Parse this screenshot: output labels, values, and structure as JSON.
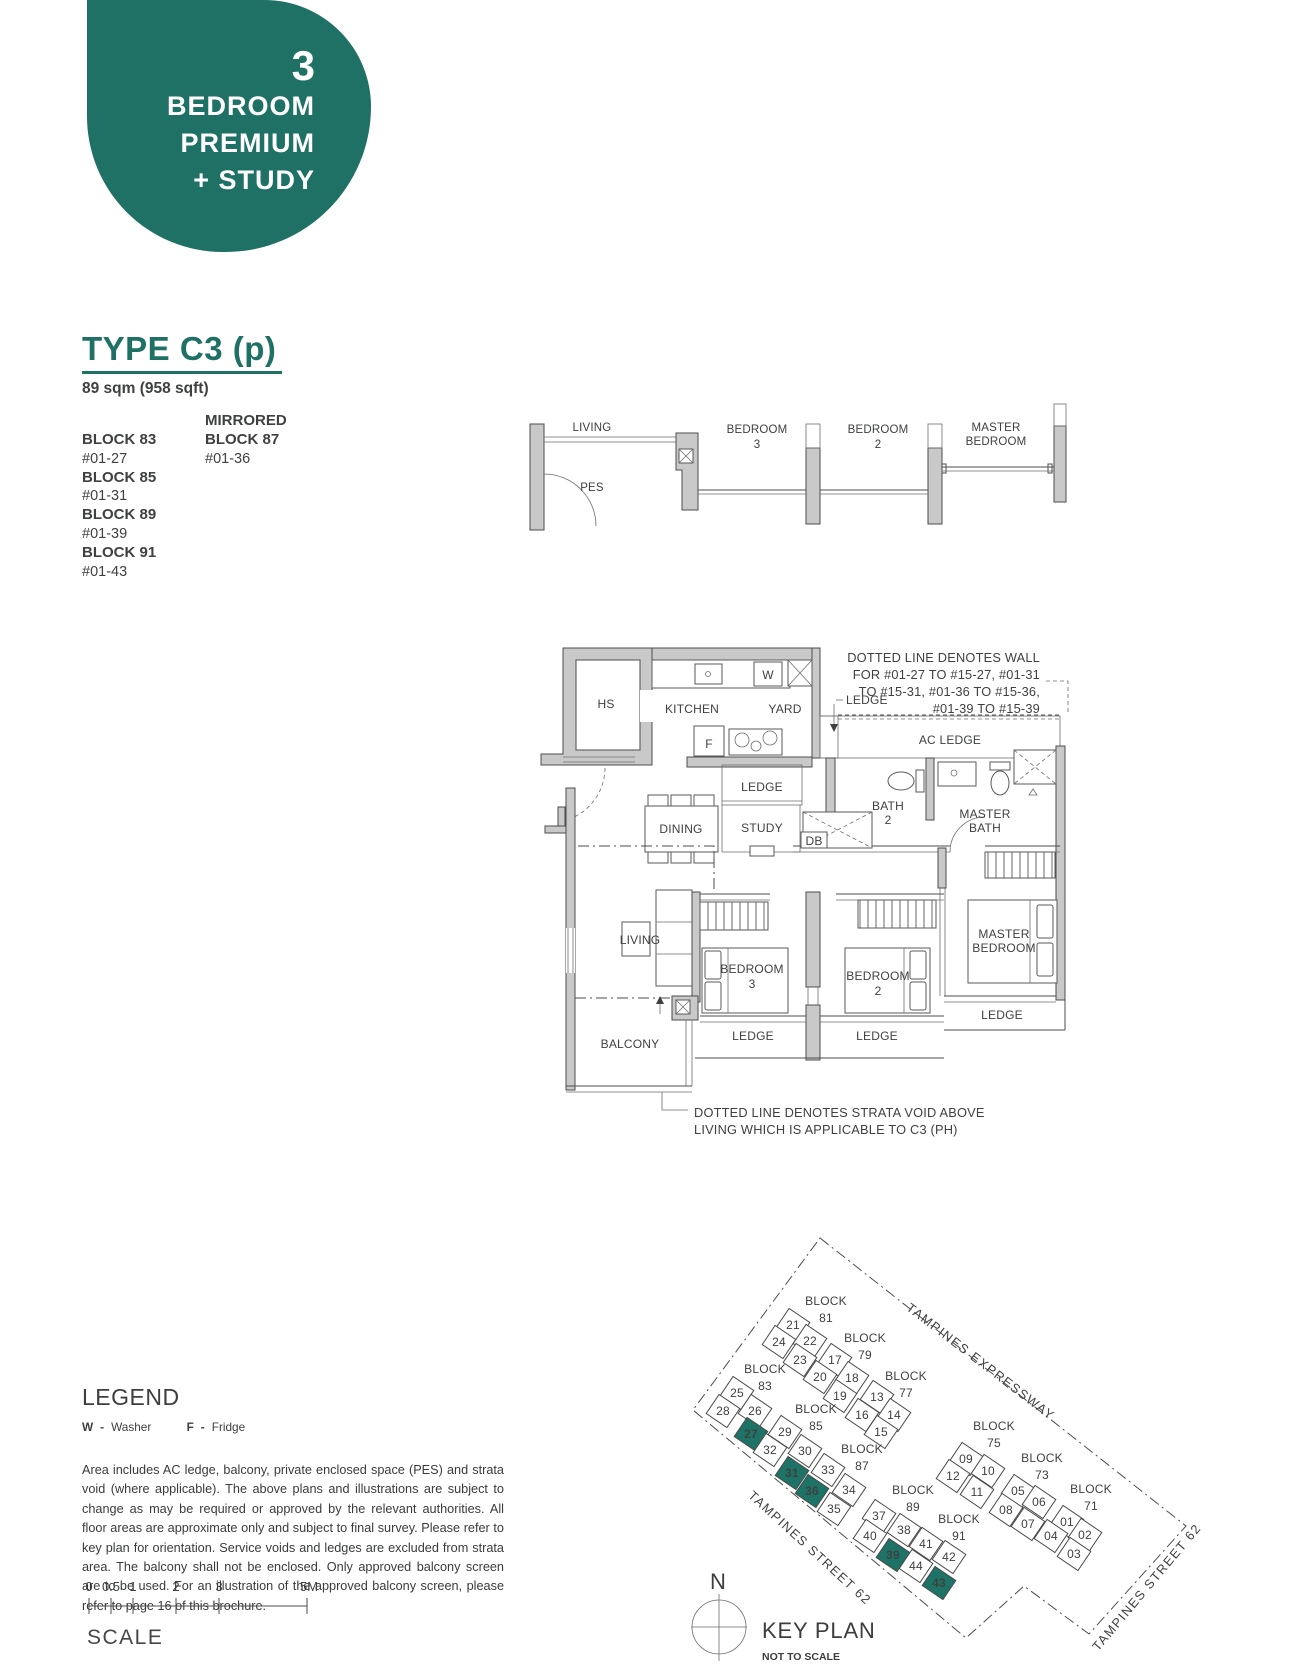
{
  "colors": {
    "accent": "#1e7164",
    "keyplan_highlight": "#1d7366",
    "wall_gray": "#c9c9c9",
    "ink": "#3f4040"
  },
  "badge": {
    "number": "3",
    "lines": [
      "BEDROOM",
      "PREMIUM",
      "+ STUDY"
    ]
  },
  "header": {
    "title": "TYPE C3 (p)",
    "area": "89 sqm (958 sqft)"
  },
  "blocks": {
    "mirrored_label": "MIRRORED",
    "left": [
      {
        "block": "BLOCK 83",
        "unit": "#01-27"
      },
      {
        "block": "BLOCK 85",
        "unit": "#01-31"
      },
      {
        "block": "BLOCK 89",
        "unit": "#01-39"
      },
      {
        "block": "BLOCK 91",
        "unit": "#01-43"
      }
    ],
    "mirrored": [
      {
        "block": "BLOCK 87",
        "unit": "#01-36"
      }
    ]
  },
  "plan": {
    "upper": {
      "living": "LIVING",
      "pes": "PES",
      "bedroom3_1": "BEDROOM",
      "bedroom3_2": "3",
      "bedroom2_1": "BEDROOM",
      "bedroom2_2": "2",
      "master_1": "MASTER",
      "master_2": "BEDROOM"
    },
    "rooms": {
      "hs": "HS",
      "kitchen": "KITCHEN",
      "yard": "YARD",
      "washer": "W",
      "fridge": "F",
      "ledge_kitchen": "LEDGE",
      "ledge_pointer": "LEDGE",
      "ac_ledge": "AC LEDGE",
      "bath2_1": "BATH",
      "bath2_2": "2",
      "master_bath_1": "MASTER",
      "master_bath_2": "BATH",
      "dining": "DINING",
      "study": "STUDY",
      "db": "DB",
      "living": "LIVING",
      "bedroom3_1": "BEDROOM",
      "bedroom3_2": "3",
      "bedroom2_1": "BEDROOM",
      "bedroom2_2": "2",
      "master_bedroom_1": "MASTER",
      "master_bedroom_2": "BEDROOM",
      "balcony": "BALCONY",
      "ledge_bedroom3": "LEDGE",
      "ledge_bedroom2": "LEDGE",
      "ledge_master": "LEDGE"
    },
    "wall_note": [
      "DOTTED LINE DENOTES WALL",
      "FOR #01-27 TO #15-27, #01-31",
      "TO #15-31, #01-36 TO #15-36,",
      "#01-39 TO #15-39"
    ],
    "strata_note": [
      "DOTTED LINE DENOTES STRATA VOID ABOVE",
      "LIVING WHICH IS APPLICABLE TO C3 (PH)"
    ]
  },
  "legend": {
    "title": "LEGEND",
    "items": [
      {
        "key": "W",
        "name": "Washer"
      },
      {
        "key": "F",
        "name": "Fridge"
      }
    ]
  },
  "disclaimer": "Area includes AC ledge, balcony, private enclosed space (PES) and strata void (where applicable). The above plans and illustrations are subject to change as may be required or approved by the relevant authorities. All floor areas are approximate only and subject to final survey. Please refer to key plan for orientation. Service voids and ledges are excluded from strata area. The balcony shall not be enclosed. Only approved balcony screen are to be used. For an illustration of the approved balcony screen, please refer to page 16 of this brochure.",
  "scale": {
    "ticks": [
      "0",
      "0.5",
      "1",
      "2",
      "3",
      "5M"
    ],
    "label": "SCALE"
  },
  "keyplan": {
    "title": "KEY PLAN",
    "subtitle": "NOT TO SCALE",
    "north": "N",
    "streets": [
      "TAMPINES EXPRESSWAY",
      "TAMPINES STREET 62",
      "TAMPINES STREET 62"
    ],
    "block_word": "BLOCK",
    "highlight_units": [
      "27",
      "31",
      "36",
      "39",
      "43"
    ],
    "blocks": [
      {
        "name": "81",
        "lx": 826,
        "ly": 1305,
        "units": [
          [
            "21",
            793,
            1325,
            0
          ],
          [
            "24",
            779,
            1342,
            0
          ],
          [
            "22",
            810,
            1341,
            0
          ],
          [
            "23",
            800,
            1360,
            0
          ]
        ]
      },
      {
        "name": "79",
        "lx": 865,
        "ly": 1342,
        "units": [
          [
            "17",
            835,
            1360,
            0
          ],
          [
            "20",
            820,
            1377,
            0
          ],
          [
            "18",
            852,
            1378,
            0
          ],
          [
            "19",
            840,
            1396,
            0
          ]
        ]
      },
      {
        "name": "77",
        "lx": 906,
        "ly": 1380,
        "units": [
          [
            "13",
            877,
            1397,
            0
          ],
          [
            "16",
            862,
            1415,
            0
          ],
          [
            "14",
            894,
            1415,
            0
          ],
          [
            "15",
            881,
            1432,
            0
          ]
        ]
      },
      {
        "name": "83",
        "lx": 765,
        "ly": 1373,
        "units": [
          [
            "25",
            737,
            1393,
            0
          ],
          [
            "28",
            723,
            1411,
            0
          ],
          [
            "26",
            755,
            1411,
            0
          ],
          [
            "27",
            751,
            1434,
            1
          ]
        ]
      },
      {
        "name": "85",
        "lx": 816,
        "ly": 1413,
        "units": [
          [
            "29",
            785,
            1432,
            0
          ],
          [
            "32",
            770,
            1450,
            0
          ],
          [
            "30",
            805,
            1451,
            0
          ],
          [
            "31",
            792,
            1473,
            1
          ]
        ]
      },
      {
        "name": "87",
        "lx": 862,
        "ly": 1453,
        "units": [
          [
            "33",
            828,
            1470,
            0
          ],
          [
            "36",
            812,
            1491,
            1
          ],
          [
            "34",
            849,
            1490,
            0
          ],
          [
            "35",
            834,
            1509,
            0
          ]
        ]
      },
      {
        "name": "89",
        "lx": 913,
        "ly": 1494,
        "units": [
          [
            "37",
            879,
            1516,
            0
          ],
          [
            "40",
            870,
            1536,
            0
          ],
          [
            "38",
            904,
            1530,
            0
          ],
          [
            "39",
            893,
            1555,
            1
          ]
        ]
      },
      {
        "name": "91",
        "lx": 959,
        "ly": 1523,
        "units": [
          [
            "41",
            926,
            1544,
            0
          ],
          [
            "44",
            916,
            1566,
            0
          ],
          [
            "42",
            949,
            1557,
            0
          ],
          [
            "43",
            939,
            1583,
            1
          ]
        ]
      },
      {
        "name": "75",
        "lx": 994,
        "ly": 1430,
        "units": [
          [
            "09",
            966,
            1459,
            0
          ],
          [
            "12",
            953,
            1476,
            0
          ],
          [
            "10",
            988,
            1471,
            0
          ],
          [
            "11",
            977,
            1492,
            0
          ]
        ]
      },
      {
        "name": "73",
        "lx": 1042,
        "ly": 1462,
        "units": [
          [
            "05",
            1018,
            1491,
            0
          ],
          [
            "08",
            1006,
            1510,
            0
          ],
          [
            "06",
            1039,
            1502,
            0
          ],
          [
            "07",
            1028,
            1524,
            0
          ]
        ]
      },
      {
        "name": "71",
        "lx": 1091,
        "ly": 1493,
        "units": [
          [
            "01",
            1067,
            1522,
            0
          ],
          [
            "04",
            1051,
            1536,
            0
          ],
          [
            "02",
            1085,
            1535,
            0
          ],
          [
            "03",
            1074,
            1554,
            0
          ]
        ]
      }
    ]
  }
}
